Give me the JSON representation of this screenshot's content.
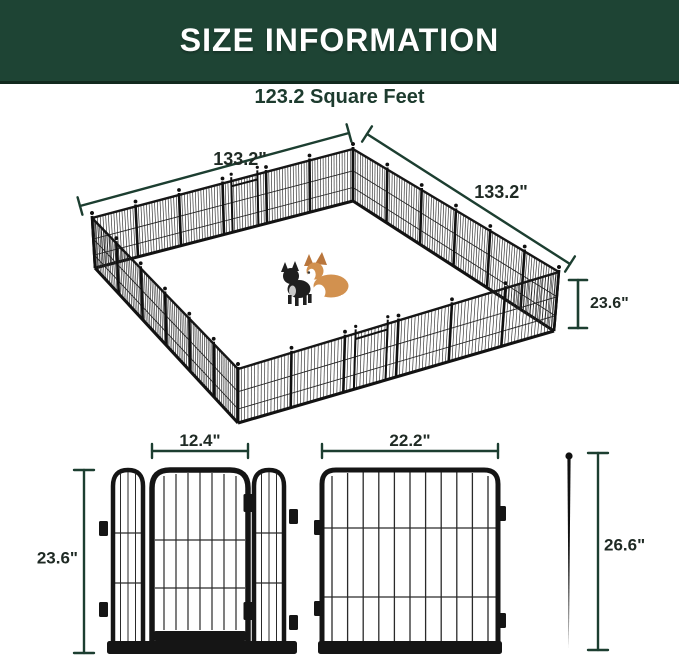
{
  "header": {
    "title": "SIZE INFORMATION"
  },
  "area": {
    "label": "123.2 Square Feet"
  },
  "pen": {
    "side_left_label": "133.2\"",
    "side_right_label": "133.2\"",
    "height_label": "23.6\""
  },
  "front_views": {
    "door_panel": {
      "door_width_label": "12.4\"",
      "panel_height_label": "23.6\""
    },
    "regular_panel": {
      "panel_width_label": "22.2\""
    },
    "ground_stake": {
      "stake_height_label": "26.6\""
    }
  },
  "colors": {
    "banner_green": "#1e4434",
    "dim_line_green": "#1c3e30",
    "label_dark": "#1f2a24",
    "fence_black": "#151515",
    "corgi_tan": "#d2914f",
    "frenchie_black": "#1f1f1f"
  }
}
